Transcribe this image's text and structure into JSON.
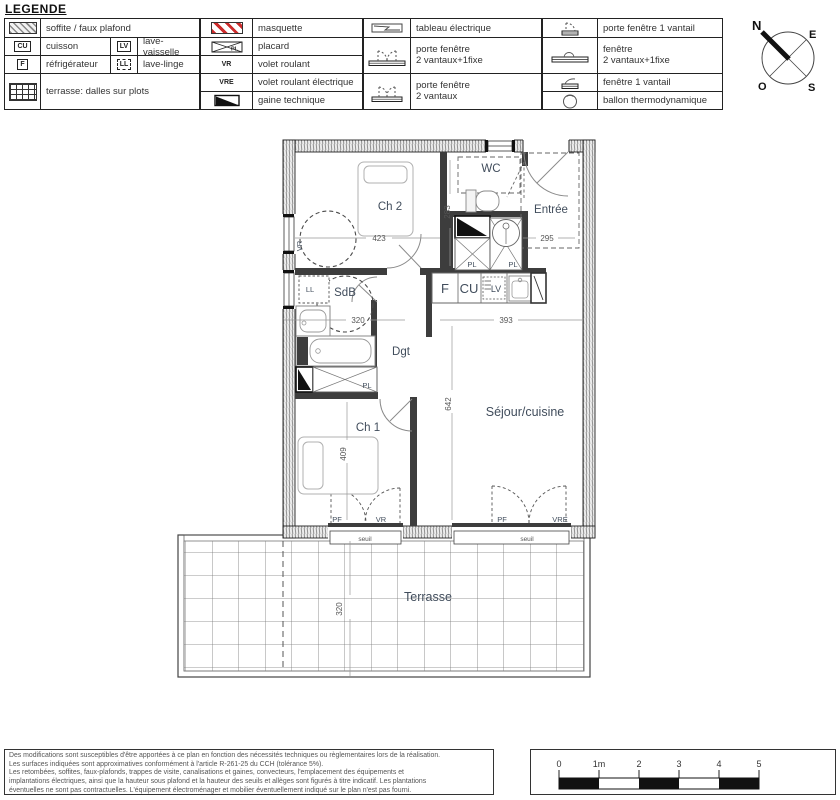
{
  "title": "LEGENDE",
  "legend": {
    "soffite": "soffite / faux plafond",
    "cu": "CU",
    "cuisson": "cuisson",
    "lv": "LV",
    "lave_vaisselle": "lave-vaisselle",
    "f": "F",
    "refrigerateur": "réfrigérateur",
    "ll": "LL",
    "lave_linge": "lave-linge",
    "terrasse_dalles": "terrasse: dalles sur plots",
    "masquette": "masquette",
    "placard": "placard",
    "pl": "PL",
    "vr": "VR",
    "volet_roulant": "volet roulant",
    "vre": "VRE",
    "volet_roulant_electrique": "volet roulant électrique",
    "gaine_technique": "gaine technique",
    "tableau_electrique": "tableau électrique",
    "pf2v1f": [
      "porte fenêtre",
      "2 vantaux+1fixe"
    ],
    "pf2v": [
      "porte fenêtre",
      "2 vantaux"
    ],
    "pf1v": "porte fenêtre 1 vantail",
    "fen2v1f": [
      "fenêtre",
      "2 vantaux+1fixe"
    ],
    "fen1v": "fenêtre 1 vantail",
    "ballon": "ballon thermodynamique"
  },
  "compass": {
    "n": "N",
    "e": "E",
    "o": "O",
    "s": "S"
  },
  "plan": {
    "rooms": {
      "ch2": "Ch 2",
      "wc": "WC",
      "entree": "Entrée",
      "sdb": "SdB",
      "dgt": "Dgt",
      "ch1": "Ch 1",
      "sejour": "Séjour/cuisine",
      "terrasse": "Terrasse"
    },
    "dims": {
      "ch2_w": "423",
      "ch2_h": "283",
      "entree_w": "295",
      "sdb_w": "320",
      "kitchen_w": "393",
      "sejour_h": "642",
      "ch1_h": "409",
      "terrasse_d": "320"
    },
    "tags": {
      "vr": "VR",
      "vre": "VRE",
      "pf": "PF",
      "pl": "PL",
      "ll": "LL",
      "f": "F",
      "cu": "CU",
      "lv": "LV",
      "seuil": "seuil"
    }
  },
  "footer": {
    "lines": [
      "Des modifications sont susceptibles d'être apportées à ce plan en fonction des nécessités techniques ou règlementaires lors de la réalisation.",
      "Les surfaces indiquées sont approximatives conformément à l'article R-261-25 du CCH (tolérance 5%).",
      "Les retombées, soffites, faux-plafonds, trappes de visite, canalisations et gaines, convecteurs, l'emplacement des équipements et",
      "implantations électriques, ainsi que la hauteur sous plafond et la hauteur des seuils et allèges sont figurés à titre indicatif. Les plantations",
      "éventuelles ne sont pas contractuelles. L'équipement électroménager et mobilier éventuellement indiqué sur le plan n'est pas fourni."
    ]
  },
  "scale": {
    "ticks": [
      "0",
      "1m",
      "2",
      "3",
      "4",
      "5"
    ]
  }
}
